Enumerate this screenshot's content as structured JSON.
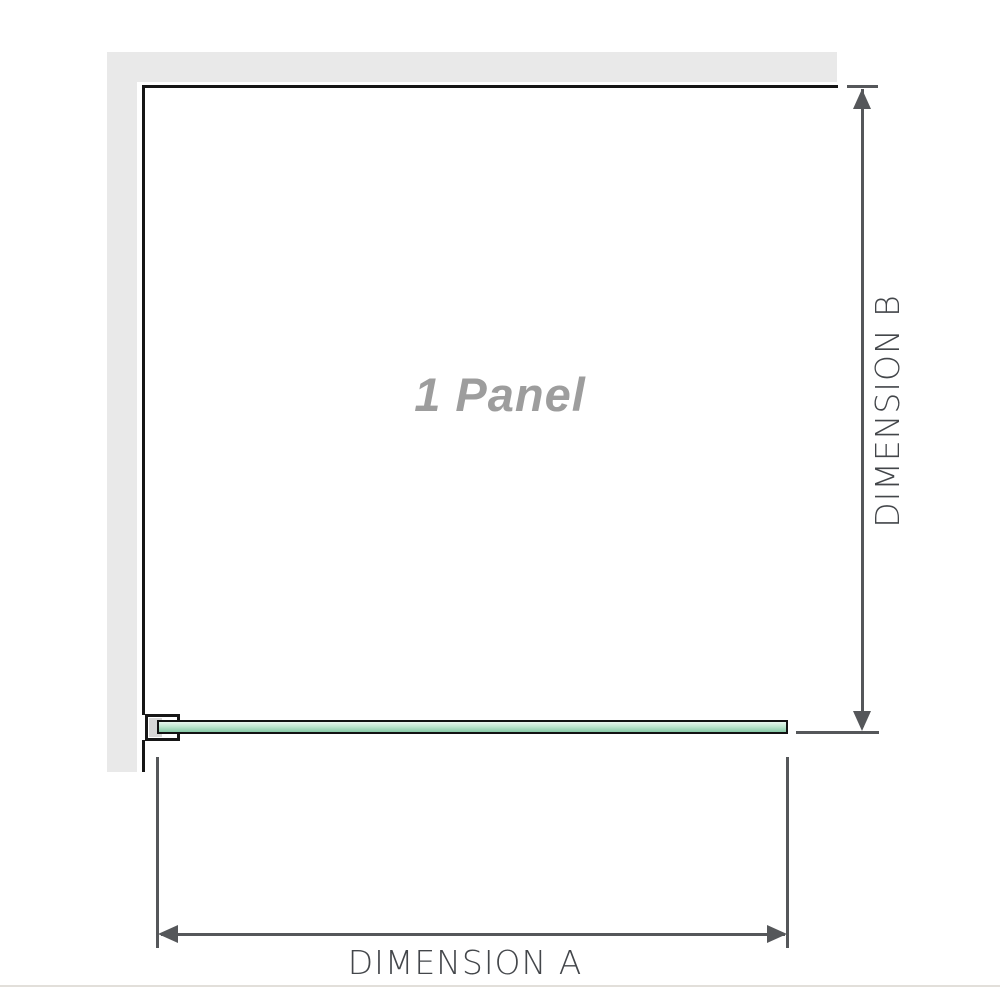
{
  "diagram": {
    "panel_label": "1 Panel",
    "dimension_a_label": "DIMENSION A",
    "dimension_b_label": "DIMENSION B"
  },
  "colors": {
    "wall_gray": "#e9e9e9",
    "outline_black": "#161616",
    "line_dark": "#55575a",
    "label_gray": "#43464a",
    "panel_label_gray": "#9d9d9d",
    "glass_green_light": "#e9f6ee",
    "glass_green_mid": "#bfe6cf",
    "glass_green_dark": "#86c9a6",
    "bracket_gray": "#d7d7d7",
    "baseline_gray": "#e2dfda"
  }
}
